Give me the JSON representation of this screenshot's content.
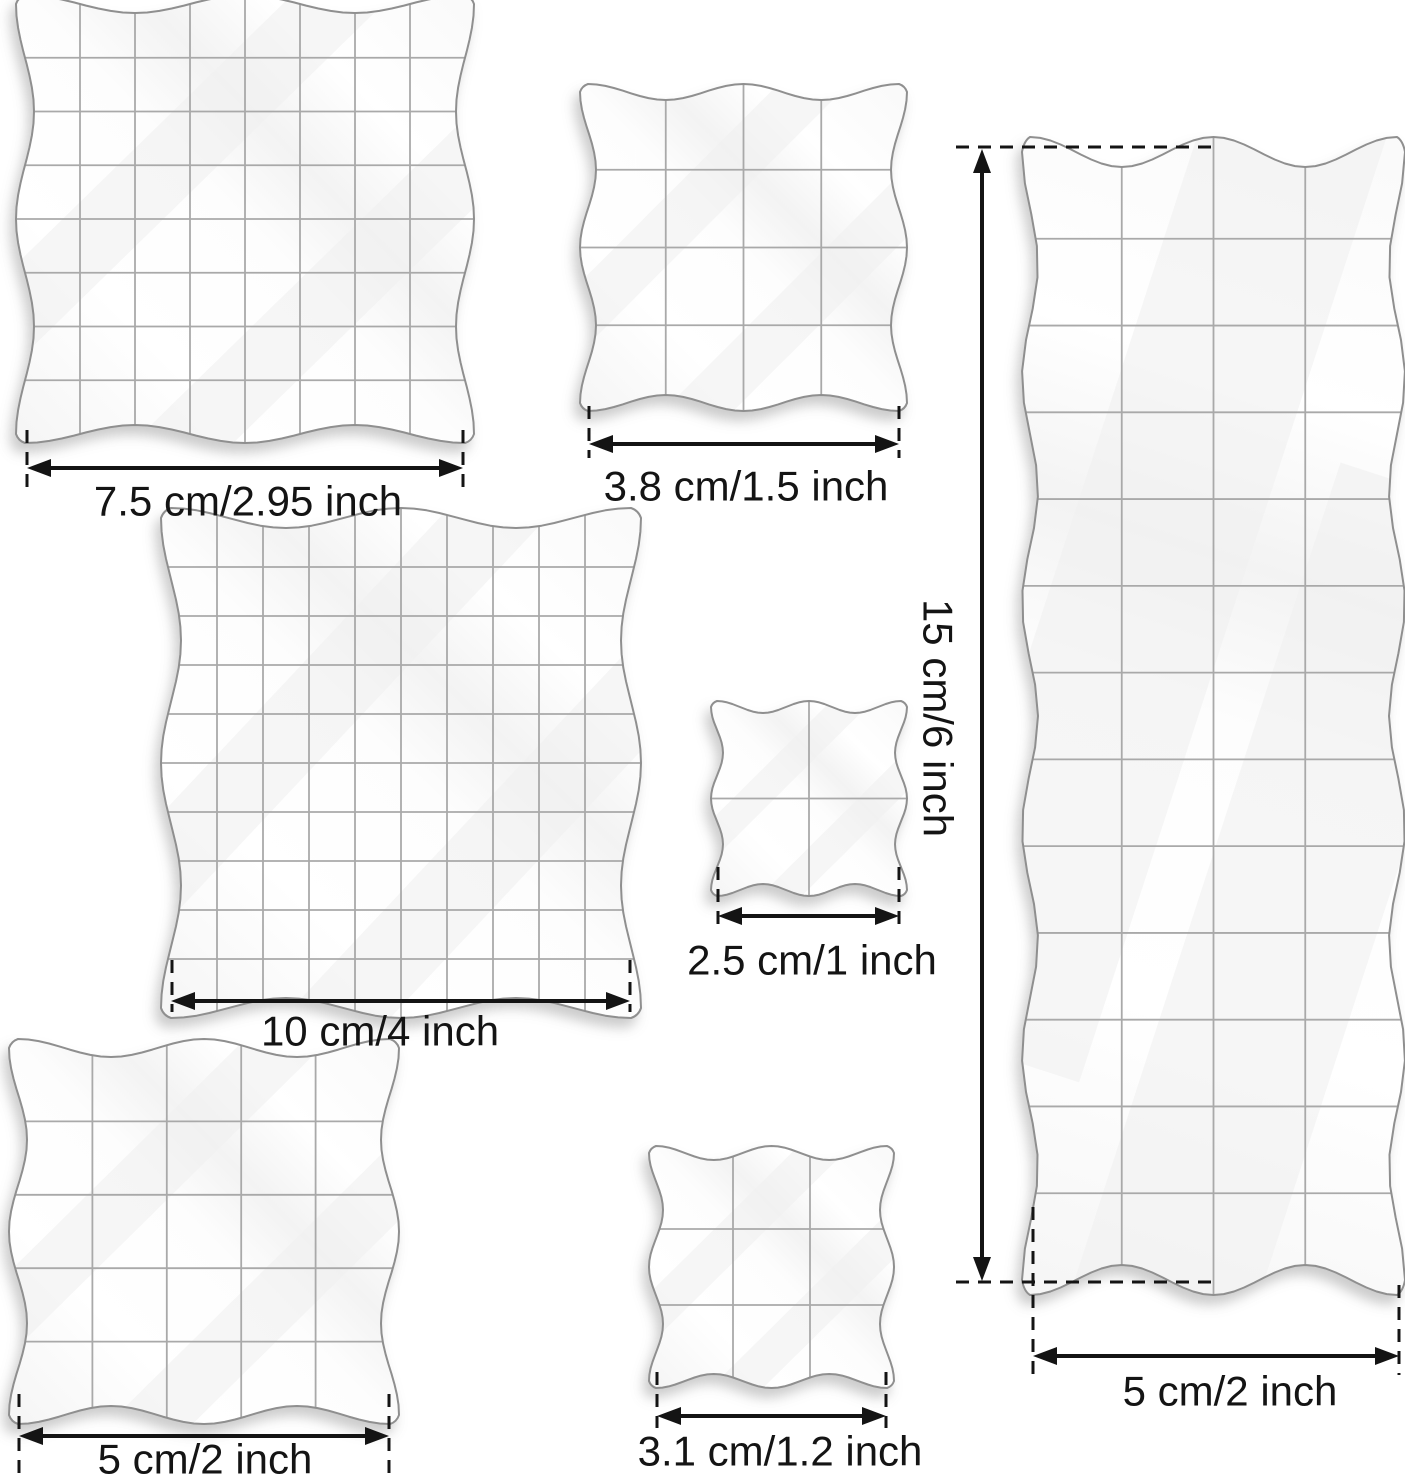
{
  "canvas": {
    "width": 1405,
    "height": 1479,
    "background": "#ffffff"
  },
  "styles": {
    "block_fill": "#ffffff",
    "block_edge_color": "#8f8f8f",
    "grid_line_color": "#a9a9a9",
    "sheen_color": "#f1f1f1",
    "shadow_color": "#8e8e8e",
    "dimension_color": "#141414",
    "label_font_size": 42
  },
  "blocks": [
    {
      "name": "stamp-block-7.5cm",
      "x": 25,
      "y": 4,
      "w": 440,
      "h": 430,
      "vlines": 7,
      "hlines": 7,
      "wave": {
        "kx": 2,
        "ky": 2,
        "ax": 9,
        "ay": 9
      }
    },
    {
      "name": "stamp-block-3.8cm",
      "x": 588,
      "y": 92,
      "w": 311,
      "h": 311,
      "vlines": 3,
      "hlines": 3,
      "wave": {
        "kx": 2,
        "ky": 2,
        "ax": 8,
        "ay": 8
      }
    },
    {
      "name": "stamp-block-15cm",
      "x": 1030,
      "y": 152,
      "w": 367,
      "h": 1128,
      "vlines": 3,
      "hlines": 12,
      "wave": {
        "kx": 2,
        "ky": 5,
        "ax": 8,
        "ay": 15
      }
    },
    {
      "name": "stamp-block-10cm",
      "x": 171,
      "y": 518,
      "w": 460,
      "h": 490,
      "vlines": 9,
      "hlines": 9,
      "wave": {
        "kx": 2,
        "ky": 2,
        "ax": 10,
        "ay": 10
      }
    },
    {
      "name": "stamp-block-2.5cm",
      "x": 717,
      "y": 707,
      "w": 184,
      "h": 183,
      "vlines": 1,
      "hlines": 1,
      "wave": {
        "kx": 2,
        "ky": 2,
        "ax": 6,
        "ay": 6
      }
    },
    {
      "name": "stamp-block-5cm-square",
      "x": 18,
      "y": 1048,
      "w": 372,
      "h": 367,
      "vlines": 4,
      "hlines": 4,
      "wave": {
        "kx": 2,
        "ky": 2,
        "ax": 9,
        "ay": 9
      }
    },
    {
      "name": "stamp-block-3.1cm",
      "x": 656,
      "y": 1153,
      "w": 231,
      "h": 228,
      "vlines": 2,
      "hlines": 2,
      "wave": {
        "kx": 2,
        "ky": 2,
        "ax": 7,
        "ay": 7
      }
    }
  ],
  "dimensions": [
    {
      "name": "dim-7-5cm",
      "label": "7.5 cm/2.95 inch",
      "orientation": "horizontal",
      "line": {
        "a": 27,
        "b": 463,
        "c": 468
      },
      "ext": [
        {
          "p": 27,
          "a": 430,
          "b": 492
        },
        {
          "p": 463,
          "a": 430,
          "b": 492
        }
      ],
      "label_pos": {
        "x": 248,
        "y": 501
      }
    },
    {
      "name": "dim-3-8cm",
      "label": "3.8 cm/1.5 inch",
      "orientation": "horizontal",
      "line": {
        "a": 589,
        "b": 899,
        "c": 444
      },
      "ext": [
        {
          "p": 589,
          "a": 406,
          "b": 458
        },
        {
          "p": 899,
          "a": 406,
          "b": 458
        }
      ],
      "label_pos": {
        "x": 746,
        "y": 486
      }
    },
    {
      "name": "dim-15cm",
      "label": "15 cm/6 inch",
      "orientation": "vertical",
      "line": {
        "a": 149,
        "b": 1281,
        "c": 982
      },
      "ext": [
        {
          "p": 147,
          "a": 956,
          "b": 1217
        },
        {
          "p": 1282,
          "a": 956,
          "b": 1215
        }
      ],
      "label_pos": {
        "x": 938,
        "y": 718
      }
    },
    {
      "name": "dim-10cm",
      "label": "10 cm/4 inch",
      "orientation": "horizontal",
      "line": {
        "a": 171,
        "b": 630,
        "c": 1001
      },
      "ext": [
        {
          "p": 172,
          "a": 960,
          "b": 1012
        },
        {
          "p": 630,
          "a": 960,
          "b": 1012
        }
      ],
      "label_pos": {
        "x": 380,
        "y": 1031
      }
    },
    {
      "name": "dim-2-5cm",
      "label": "2.5 cm/1 inch",
      "orientation": "horizontal",
      "line": {
        "a": 718,
        "b": 899,
        "c": 916
      },
      "ext": [
        {
          "p": 718,
          "a": 867,
          "b": 928
        },
        {
          "p": 899,
          "a": 867,
          "b": 928
        }
      ],
      "label_pos": {
        "x": 812,
        "y": 960
      }
    },
    {
      "name": "dim-5cm-square",
      "label": "5 cm/2 inch",
      "orientation": "horizontal",
      "line": {
        "a": 19,
        "b": 389,
        "c": 1436
      },
      "ext": [
        {
          "p": 19,
          "a": 1394,
          "b": 1477
        },
        {
          "p": 389,
          "a": 1394,
          "b": 1477
        }
      ],
      "label_pos": {
        "x": 205,
        "y": 1459
      }
    },
    {
      "name": "dim-3-1cm",
      "label": "3.1 cm/1.2 inch",
      "orientation": "horizontal",
      "line": {
        "a": 657,
        "b": 886,
        "c": 1416
      },
      "ext": [
        {
          "p": 657,
          "a": 1372,
          "b": 1428
        },
        {
          "p": 886,
          "a": 1372,
          "b": 1428
        }
      ],
      "label_pos": {
        "x": 780,
        "y": 1451
      }
    },
    {
      "name": "dim-5cm-long",
      "label": "5 cm/2 inch",
      "orientation": "horizontal",
      "line": {
        "a": 1033,
        "b": 1399,
        "c": 1356
      },
      "ext": [
        {
          "p": 1033,
          "a": 1207,
          "b": 1375
        },
        {
          "p": 1399,
          "a": 1285,
          "b": 1375
        }
      ],
      "label_pos": {
        "x": 1230,
        "y": 1391
      }
    }
  ]
}
